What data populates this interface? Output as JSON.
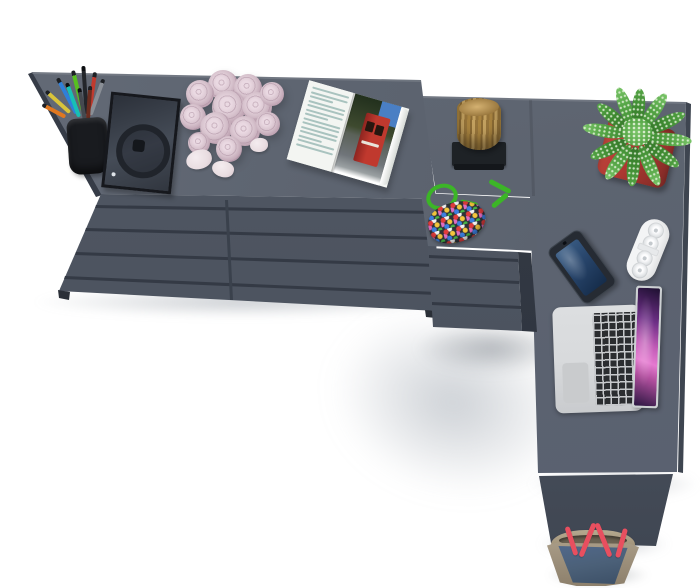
{
  "scene": {
    "type": "furniture-product-photo",
    "description": "Top view of a graphite gray L-shaped corner desk combined with a double chest of drawers and a three-drawer pedestal, decorated with desk objects, on a white studio background",
    "background": "#ffffff"
  },
  "items": [
    {
      "name": "chest-of-drawers-left",
      "drawers": 4
    },
    {
      "name": "chest-of-drawers-right",
      "drawers": 4
    },
    {
      "name": "drawer-pedestal",
      "drawers": 3
    },
    {
      "name": "corner-desk"
    },
    {
      "name": "pencil-cup"
    },
    {
      "name": "photo-frame"
    },
    {
      "name": "rose-bouquet"
    },
    {
      "name": "rose-petals",
      "count": 3
    },
    {
      "name": "open-magazine"
    },
    {
      "name": "wooden-stump-decor"
    },
    {
      "name": "bead-pouch"
    },
    {
      "name": "potted-plant"
    },
    {
      "name": "smartphone"
    },
    {
      "name": "white-speaker"
    },
    {
      "name": "laptop"
    },
    {
      "name": "tote-bag"
    }
  ],
  "palette": {
    "bg": "#ffffff",
    "surface-top": "#5d6470",
    "surface-front": "#4e5561",
    "drawer-line": "#343a45",
    "seam-line": "#3a414c",
    "side-dark": "#363c47",
    "desk-edge": "#3e4550",
    "leg-panel": "#4a515d",
    "leg-panel-dark": "#3e4551",
    "foot-dark": "#2a2f37",
    "highlight": "rgba(255,255,255,0.12)",
    "cup-black": "#191b1f",
    "pen-green": "#57c01f",
    "pen-black": "#23262b",
    "pen-blue": "#2f7fd9",
    "pen-red": "#c03a2e",
    "pen-yellow": "#d9c43a",
    "pen-silver": "#8a8f96",
    "pen-teal": "#17c0b4",
    "pen-maroon": "#6b2d20",
    "pen-orange": "#e07820",
    "pen-gray": "#45494f",
    "frame-black": "#16181d",
    "frame-glass-1": "#2b3039",
    "frame-glass-2": "#454c57",
    "frame-ring": "#20242b",
    "rose": "#d5c0cb",
    "rose-dark": "#b799aa",
    "rose-light": "#ead9e2",
    "petal": "#e9dde1",
    "mag-page": "#f3f5f2",
    "mag-text": "#a9c3bf",
    "mag-sky": "#4a7fc4",
    "mag-trees-1": "#22301d",
    "mag-trees-2": "#3e4a2f",
    "mag-red": "#c0392e",
    "mag-red-dark": "#8e2520",
    "mag-road": "#70757a",
    "mag-curl": "#d6dad6",
    "stump-1": "#a8833f",
    "stump-2": "#8a6a34",
    "stump-3": "#c2a05f",
    "stump-top": "#d4b171",
    "stand-black": "#1e2226",
    "cord-green": "#3cb527",
    "bead-base": "#2e3238",
    "bead-red": "#e03c3c",
    "bead-yellow": "#f3c63c",
    "bead-blue": "#3c7fe0",
    "bead-green": "#46b546",
    "bead-pink": "#e06cc0",
    "bead-white": "#f2f2f2",
    "pot-red": "#b23a33",
    "pot-red-light": "#c04a40",
    "pot-red-dark": "#7e2a26",
    "plant-green": "#55a546",
    "plant-green-dark": "#3e8a31",
    "plant-green-light": "#79c468",
    "phone-body": "#262b33",
    "phone-screen-1": "#3a5d85",
    "phone-screen-2": "#152c4a",
    "speaker-white": "#f3f4f5",
    "speaker-ring": "#d2d6d9",
    "speaker-dot": "#c4c9cd",
    "laptop-silver": "#d8dadc",
    "laptop-silver-dark": "#c9cbce",
    "laptop-key": "#2b2d30",
    "laptop-keygap": "#c7c9cc",
    "trackpad": "#c9cbcd",
    "screen-1": "#1d1030",
    "screen-2": "#6d2f86",
    "screen-3": "#c25bb7",
    "screen-4": "#e57ad0",
    "bag-khaki": "#a89b86",
    "bag-khaki-dark": "#8d806c",
    "bag-blue": "#4b6078",
    "bag-blue-dark": "#3c4f66",
    "bag-inner": "#6b6252",
    "bag-strap": "#e84f5f"
  }
}
